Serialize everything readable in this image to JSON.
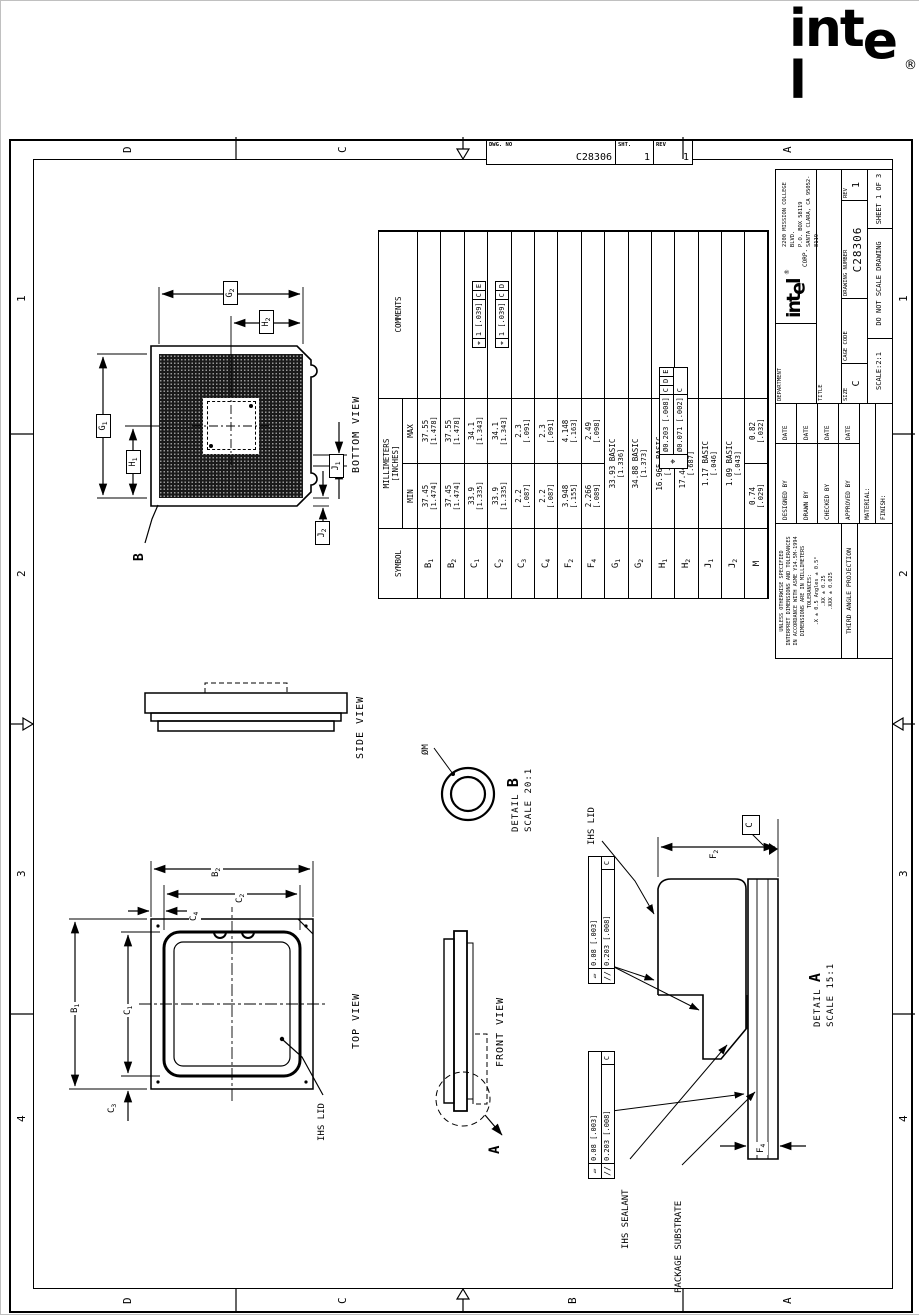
{
  "page_logo": {
    "text": "intel",
    "reg": "®"
  },
  "dwg_strip": {
    "dwg_no_label": "DWG. NO",
    "dwg_no": "C28306",
    "sht_label": "SHT.",
    "sht": "1",
    "rev_label": "REV",
    "rev": "1"
  },
  "zones": {
    "left_letters": [
      "D",
      "C",
      "B",
      "A"
    ],
    "right_letters": [
      "D",
      "C",
      "A"
    ],
    "top_numbers": [
      "4",
      "3",
      "2",
      "1"
    ],
    "bottom_numbers": [
      "4",
      "3",
      "2",
      "1"
    ]
  },
  "captions": {
    "bottom_view": "BOTTOM VIEW",
    "top_view": "TOP VIEW",
    "side_view": "SIDE VIEW",
    "front_view": "FRONT VIEW",
    "detail_b_word": "DETAIL",
    "detail_b_letter": "B",
    "detail_b_scale": "SCALE 20:1",
    "detail_a_word": "DETAIL",
    "detail_a_letter": "A",
    "detail_a_scale": "SCALE 15:1"
  },
  "callouts": {
    "phi_m": "ØM",
    "ihs_lid_top": "IHS LID",
    "ihs_lid_detail": "IHS LID",
    "ihs_sealant": "IHS SEALANT",
    "package_substrate": "PACKAGE SUBSTRATE",
    "datum_b": "B",
    "datum_a": "A",
    "datum_c": "C"
  },
  "dims": {
    "g1": {
      "b": "G",
      "s": "1"
    },
    "g2": {
      "b": "G",
      "s": "2"
    },
    "h1": {
      "b": "H",
      "s": "1"
    },
    "h2": {
      "b": "H",
      "s": "2"
    },
    "j1": {
      "b": "J",
      "s": "1"
    },
    "j2": {
      "b": "J",
      "s": "2"
    },
    "b1": {
      "b": "B",
      "s": "1"
    },
    "b2": {
      "b": "B",
      "s": "2"
    },
    "c1": {
      "b": "C",
      "s": "1"
    },
    "c2": {
      "b": "C",
      "s": "2"
    },
    "c3": {
      "b": "C",
      "s": "3"
    },
    "c4": {
      "b": "C",
      "s": "4"
    },
    "f2": {
      "b": "F",
      "s": "2"
    },
    "f4": {
      "b": "F",
      "s": "4"
    }
  },
  "lid_fcf": {
    "sym1": "▱",
    "val1": "0.08 [.003]",
    "sym2": "//",
    "val2": "0.203 [.008]",
    "ref2": "C"
  },
  "substrate_fcf": {
    "sym1": "▱",
    "val1": "0.08 [.003]",
    "sym2": "//",
    "val2": "0.203 [.008]",
    "ref2": "C"
  },
  "table": {
    "headers": {
      "symbol": "SYMBOL",
      "millimeters": "MILLIMETERS",
      "inches": "[INCHES]",
      "min": "MIN",
      "max": "MAX",
      "comments": "COMMENTS"
    },
    "rows": [
      {
        "sym": "B",
        "sub": "1",
        "min_mm": "37.45",
        "min_in": "[1.474]",
        "max_mm": "37.55",
        "max_in": "[1.478]"
      },
      {
        "sym": "B",
        "sub": "2",
        "min_mm": "37.45",
        "min_in": "[1.474]",
        "max_mm": "37.55",
        "max_in": "[1.478]"
      },
      {
        "sym": "C",
        "sub": "1",
        "min_mm": "33.9",
        "min_in": "[1.335]",
        "max_mm": "34.1",
        "max_in": "[1.343]",
        "fcf": [
          "⌖",
          "1 [.039]",
          "C",
          "E"
        ]
      },
      {
        "sym": "C",
        "sub": "2",
        "min_mm": "33.9",
        "min_in": "[1.335]",
        "max_mm": "34.1",
        "max_in": "[1.343]",
        "fcf": [
          "⌖",
          "1 [.039]",
          "C",
          "D"
        ]
      },
      {
        "sym": "C",
        "sub": "3",
        "min_mm": "2.2",
        "min_in": "[.087]",
        "max_mm": "2.3",
        "max_in": "[.091]"
      },
      {
        "sym": "C",
        "sub": "4",
        "min_mm": "2.2",
        "min_in": "[.087]",
        "max_mm": "2.3",
        "max_in": "[.091]"
      },
      {
        "sym": "F",
        "sub": "2",
        "min_mm": "3.948",
        "min_in": "[.155]",
        "max_mm": "4.148",
        "max_in": "[.163]"
      },
      {
        "sym": "F",
        "sub": "4",
        "min_mm": "2.266",
        "min_in": "[.089]",
        "max_mm": "2.49",
        "max_in": "[.098]"
      },
      {
        "sym": "G",
        "sub": "1",
        "basic_mm": "33.93 BASIC",
        "basic_in": "[1.336]"
      },
      {
        "sym": "G",
        "sub": "2",
        "basic_mm": "34.88 BASIC",
        "basic_in": "[1.373]"
      },
      {
        "sym": "H",
        "sub": "1",
        "basic_mm": "16.965 BASIC",
        "basic_in": "[.668]"
      },
      {
        "sym": "H",
        "sub": "2",
        "basic_mm": "17.44 BASIC",
        "basic_in": "[.687]"
      },
      {
        "sym": "J",
        "sub": "1",
        "basic_mm": "1.17 BASIC",
        "basic_in": "[.046]"
      },
      {
        "sym": "J",
        "sub": "2",
        "basic_mm": "1.09 BASIC",
        "basic_in": "[.043]"
      },
      {
        "sym": "M",
        "sub": "",
        "min_mm": "0.74",
        "min_in": "[.029]",
        "max_mm": "0.82",
        "max_in": "[.032]"
      }
    ],
    "composite_fcf": {
      "sym": "⌖",
      "row1": [
        "Ø0.203 [.008]",
        "C",
        "D",
        "E"
      ],
      "row2": [
        "Ø0.071 [.002]",
        "C"
      ]
    }
  },
  "title_block": {
    "note_lines": [
      "UNLESS OTHERWISE SPECIFIED",
      "INTERPRET DIMENSIONS AND TOLERANCES",
      "IN ACCORDANCE WITH ASME Y14.5M-1994",
      "DIMENSIONS ARE IN MILLIMETERS",
      "TOLERANCES:",
      ".X ± 0.5   Angles ± 0.5°",
      ".XX ± 0.25",
      ".XXX ± 0.025"
    ],
    "third_angle": "THIRD ANGLE PROJECTION",
    "designed_by": "DESIGNED BY",
    "drawn_by": "DRAWN BY",
    "checked_by": "CHECKED BY",
    "approved_by": "APPROVED BY",
    "date": "DATE",
    "material": "MATERIAL:",
    "finish": "FINISH:",
    "department": "DEPARTMENT",
    "corp_logo": "intel",
    "corp_reg": "®",
    "corp": "CORP.",
    "address_lines": [
      "2200 MISSION COLLEGE BLVD.",
      "P.O. BOX 58119",
      "SANTA CLARA, CA 95052-8119"
    ],
    "title_label": "TITLE",
    "size_label": "SIZE",
    "size": "C",
    "cage_label": "CAGE CODE",
    "dwg_label": "DRAWING NUMBER",
    "dwg_no": "C28306",
    "rev_label": "REV",
    "rev": "1",
    "scale": "SCALE:2:1",
    "no_scale": "DO NOT SCALE DRAWING",
    "sheet": "SHEET 1 OF 3"
  }
}
